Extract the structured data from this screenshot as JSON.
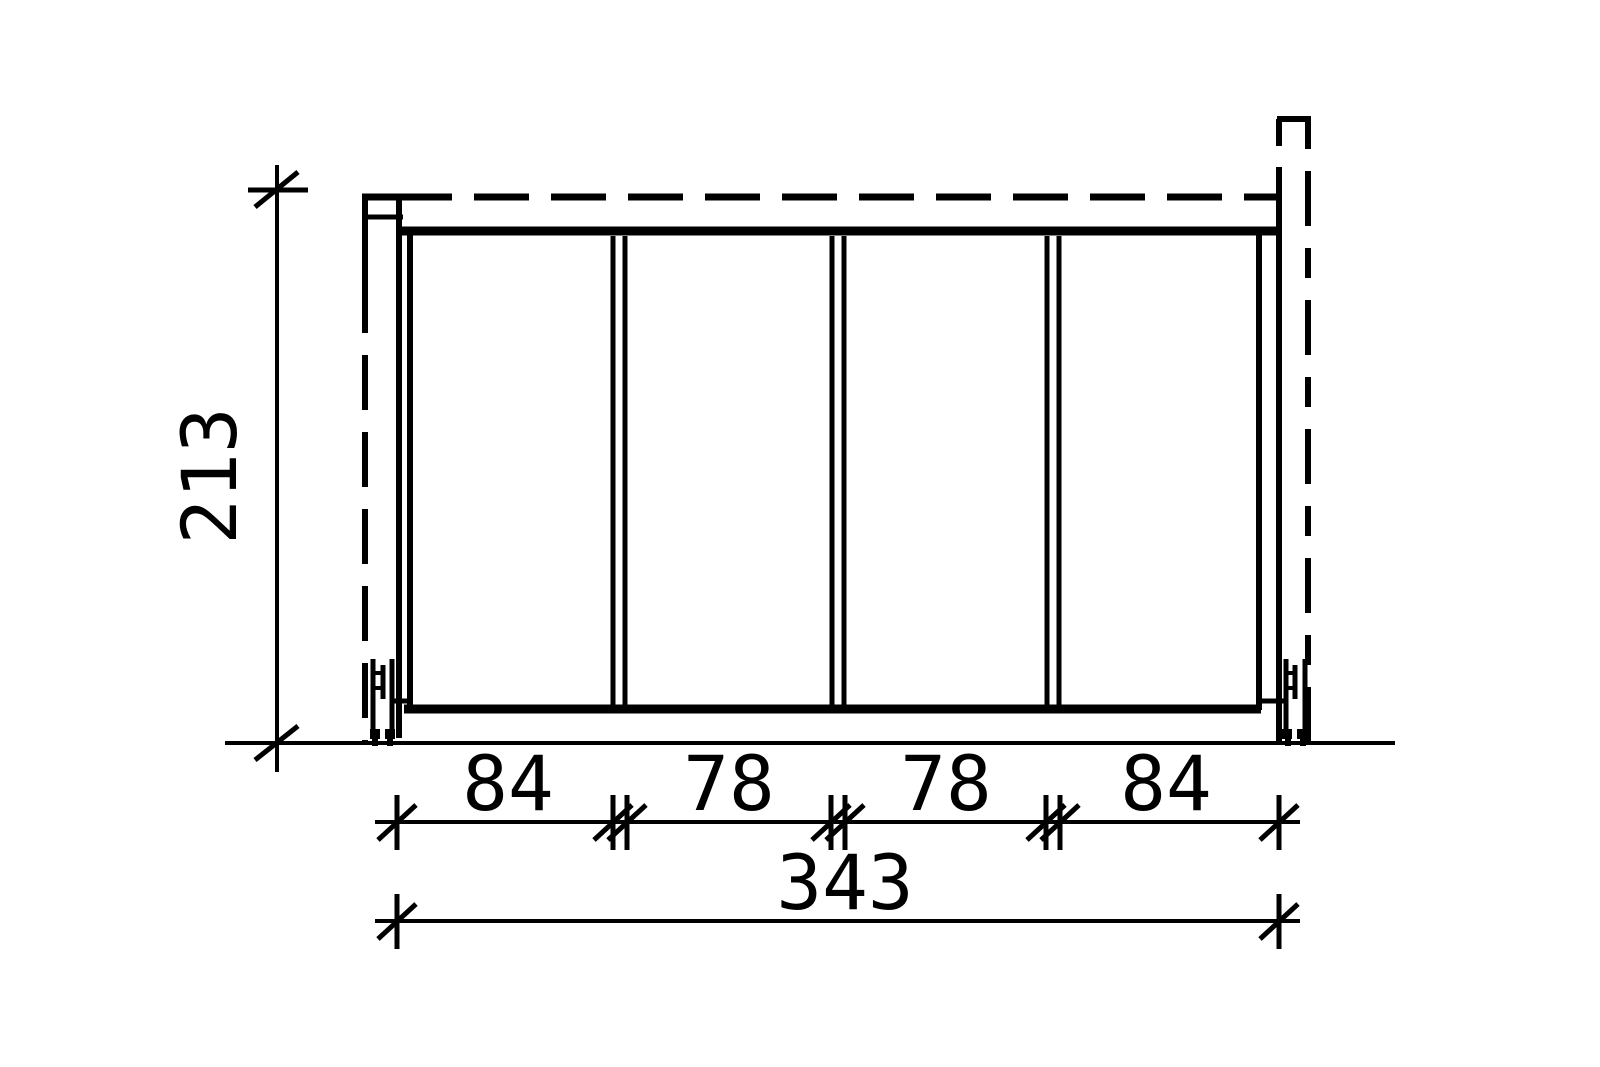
{
  "drawing": {
    "background_color": "#ffffff",
    "line_color": "#000000",
    "dimensions": {
      "height_label": "213",
      "segment_labels": [
        "84",
        "78",
        "78",
        "84"
      ],
      "total_width_label": "343"
    }
  }
}
